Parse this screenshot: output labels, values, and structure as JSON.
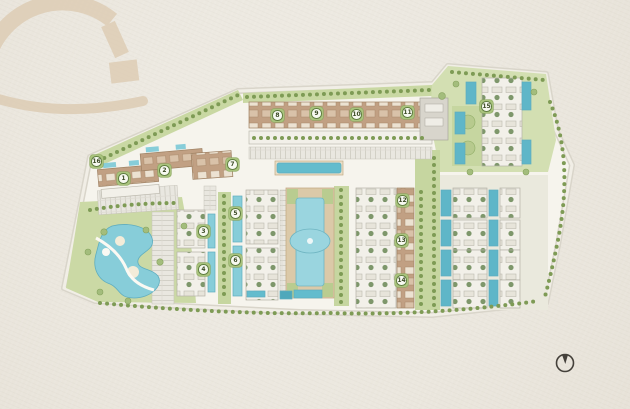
{
  "page": {
    "description": "Architectural resort master plan illustration on textured paper background",
    "background_color": "#ece8e0"
  },
  "plan": {
    "badges": [
      {
        "label": "1"
      },
      {
        "label": "2"
      },
      {
        "label": "3"
      },
      {
        "label": "4"
      },
      {
        "label": "5"
      },
      {
        "label": "6"
      },
      {
        "label": "7"
      },
      {
        "label": "8"
      },
      {
        "label": "9"
      },
      {
        "label": "10"
      },
      {
        "label": "11"
      },
      {
        "label": "12"
      },
      {
        "label": "13"
      },
      {
        "label": "14"
      },
      {
        "label": "15"
      },
      {
        "label": "16"
      }
    ],
    "icons": {
      "watermark": "arched-gate-logo",
      "north_arrow": "north-arrow-compass"
    },
    "colors": {
      "paper": "#ece8e0",
      "site_ground": "#f6f4ed",
      "green": "#c9d8a3",
      "green_dark": "#7e9b55",
      "pool": "#87cdd9",
      "pool_deep": "#5fb6c8",
      "building_tan": "#c1a083",
      "building_light": "#f2f0e9",
      "parking": "#e9e7e0",
      "road": "#d9d5ca",
      "deck": "#dbc9a8",
      "watermark_beige": "#decdb5",
      "ink": "#44403a",
      "badge_green": "#a9c37d"
    }
  }
}
